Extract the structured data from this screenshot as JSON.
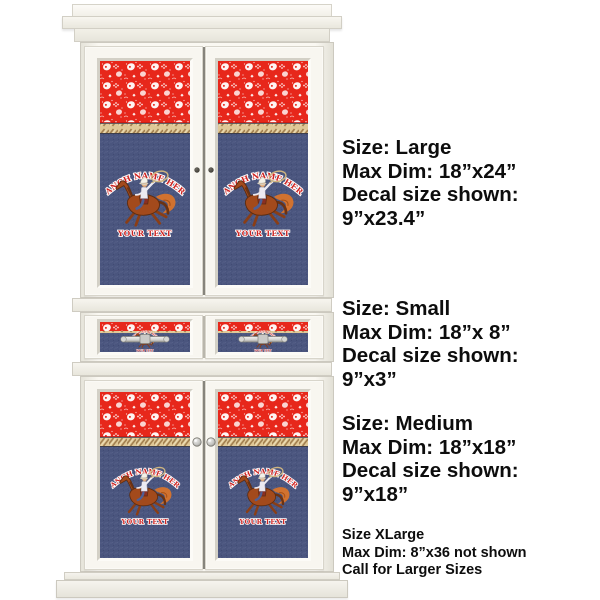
{
  "product": {
    "description": "White armoire cabinet mockup with western rodeo bandana decals",
    "decal": {
      "ranch_text": "Ranch Name Here",
      "your_text": "Your Text"
    },
    "colors": {
      "cabinet_white": "#f8f6f0",
      "bandana_red": "#e7271b",
      "denim_blue": "#4a557e",
      "rope_tan": "#dfc897",
      "decal_text_red": "#cf2321",
      "hardware_silver": "#cfcfcc",
      "panel_text": "#0d0d0d"
    }
  },
  "size_panel": {
    "blocks": [
      {
        "size_label": "Size: Large",
        "max_dim": "Max Dim: 18”x24”",
        "decal_line1": "Decal size shown:",
        "decal_line2": "9”x23.4”"
      },
      {
        "size_label": "Size: Small",
        "max_dim": "Max Dim: 18”x 8”",
        "decal_line1": "Decal size shown:",
        "decal_line2": "9”x3”"
      },
      {
        "size_label": "Size: Medium",
        "max_dim": "Max Dim: 18”x18”",
        "decal_line1": "Decal size shown:",
        "decal_line2": "9”x18”"
      }
    ],
    "note": {
      "line1": "Size XLarge",
      "line2": "Max Dim: 8”x36 not shown",
      "line3": "Call for Larger Sizes"
    }
  }
}
